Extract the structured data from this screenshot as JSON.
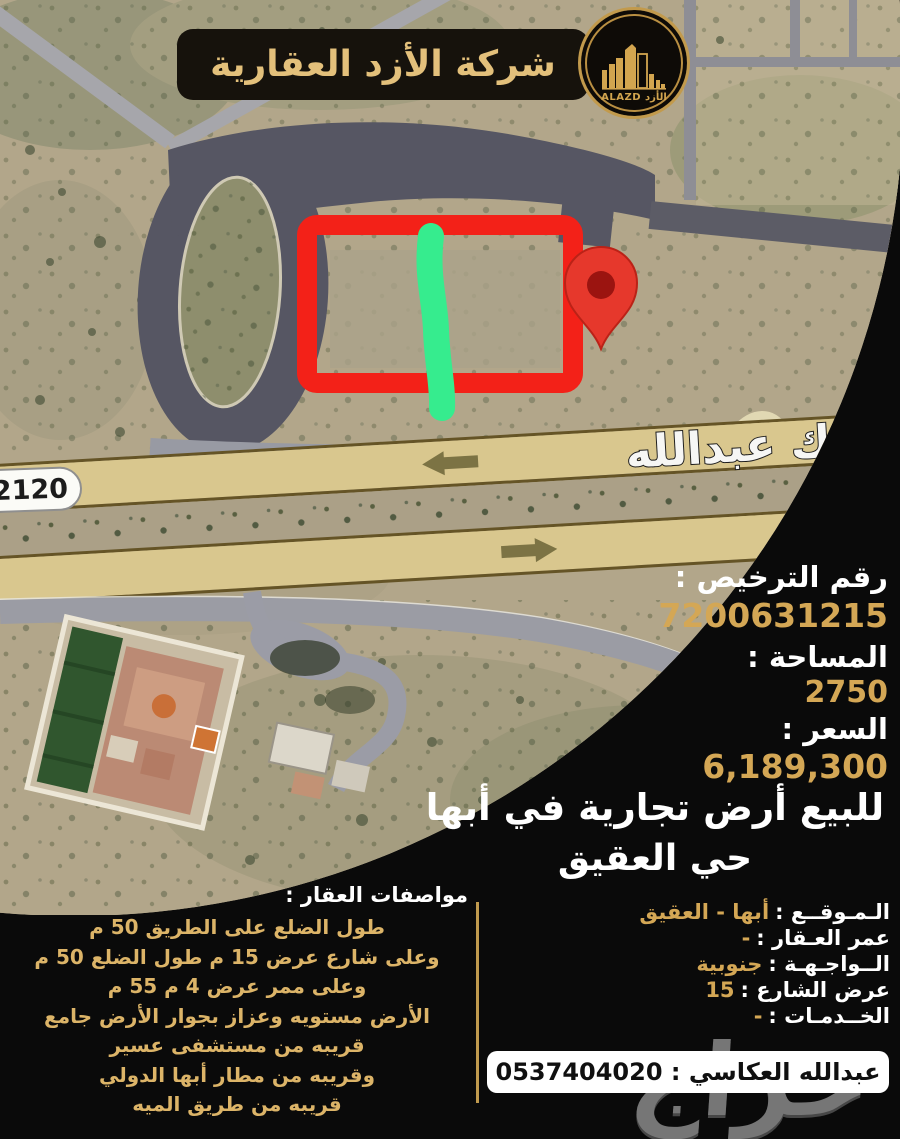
{
  "brand": {
    "title": "شركة الأزد العقارية",
    "logo_text": "ALAZD الأزد"
  },
  "map": {
    "route_badge": "2120",
    "street_name": "الملك عبدالله"
  },
  "info": {
    "license_label": "رقم الترخيص :",
    "license_value": "7200631215",
    "area_label": "المساحة :",
    "area_value": "2750",
    "price_label": "السعر :",
    "price_value": "6,189,300"
  },
  "headline": {
    "line1": "للبيع أرض تجارية في أبها",
    "line2": "حي العقيق"
  },
  "details": {
    "rows": [
      {
        "label": "الـمـوقــع :",
        "value": "أبها - العقيق"
      },
      {
        "label": "عمر العـقار :",
        "value": "-"
      },
      {
        "label": "الــواجـهـة :",
        "value": "جنوبية"
      },
      {
        "label": "عرض الشارع :",
        "value": "15"
      },
      {
        "label": "الخــدمـات :",
        "value": "-"
      }
    ]
  },
  "specs": {
    "title": "مواصفات العقار :",
    "lines": [
      "طول الضلع على الطريق 50 م",
      "وعلى شارع عرض 15 م طول الضلع 50 م",
      "وعلى ممر عرض 4 م 55 م",
      "الأرض مستويه وعزاز بجوار الأرض جامع",
      "قريبه من مستشفى عسير",
      "وقريبه من مطار أبها الدولي",
      "قريبه من طريق الميه"
    ]
  },
  "contact": {
    "text": "عبدالله العكاسي : 0537404020"
  },
  "watermark": "حراج",
  "colors": {
    "gold": "#d4a755",
    "gold_light": "#e3c07b",
    "red_annotation": "#f32118",
    "green_annotation": "#36ec8e",
    "panel_black": "#0a0a0a"
  }
}
